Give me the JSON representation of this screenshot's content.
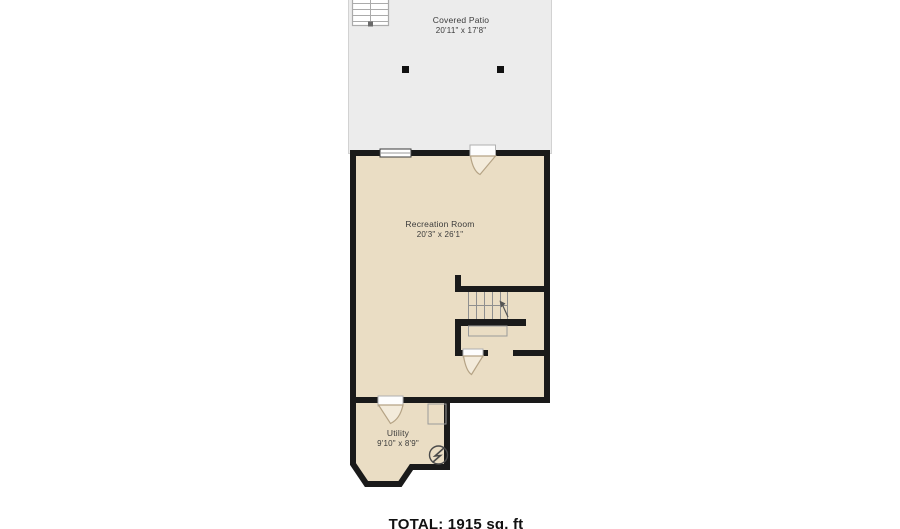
{
  "floorplan": {
    "patio": {
      "name": "Covered Patio",
      "dims": "20'11\" x 17'8\""
    },
    "recreation": {
      "name": "Recreation Room",
      "dims": "20'3\" x 26'1\""
    },
    "utility": {
      "name": "Utility",
      "dims": "9'10\" x 8'9\""
    },
    "total": "TOTAL: 1915 sq. ft",
    "colors": {
      "wall": "#1a1a1a",
      "room_fill": "#eaddc4",
      "patio_fill": "#ececec",
      "door_fill": "#f3ebdb",
      "thin_line": "#9a9a9a",
      "background": "#ffffff"
    }
  }
}
